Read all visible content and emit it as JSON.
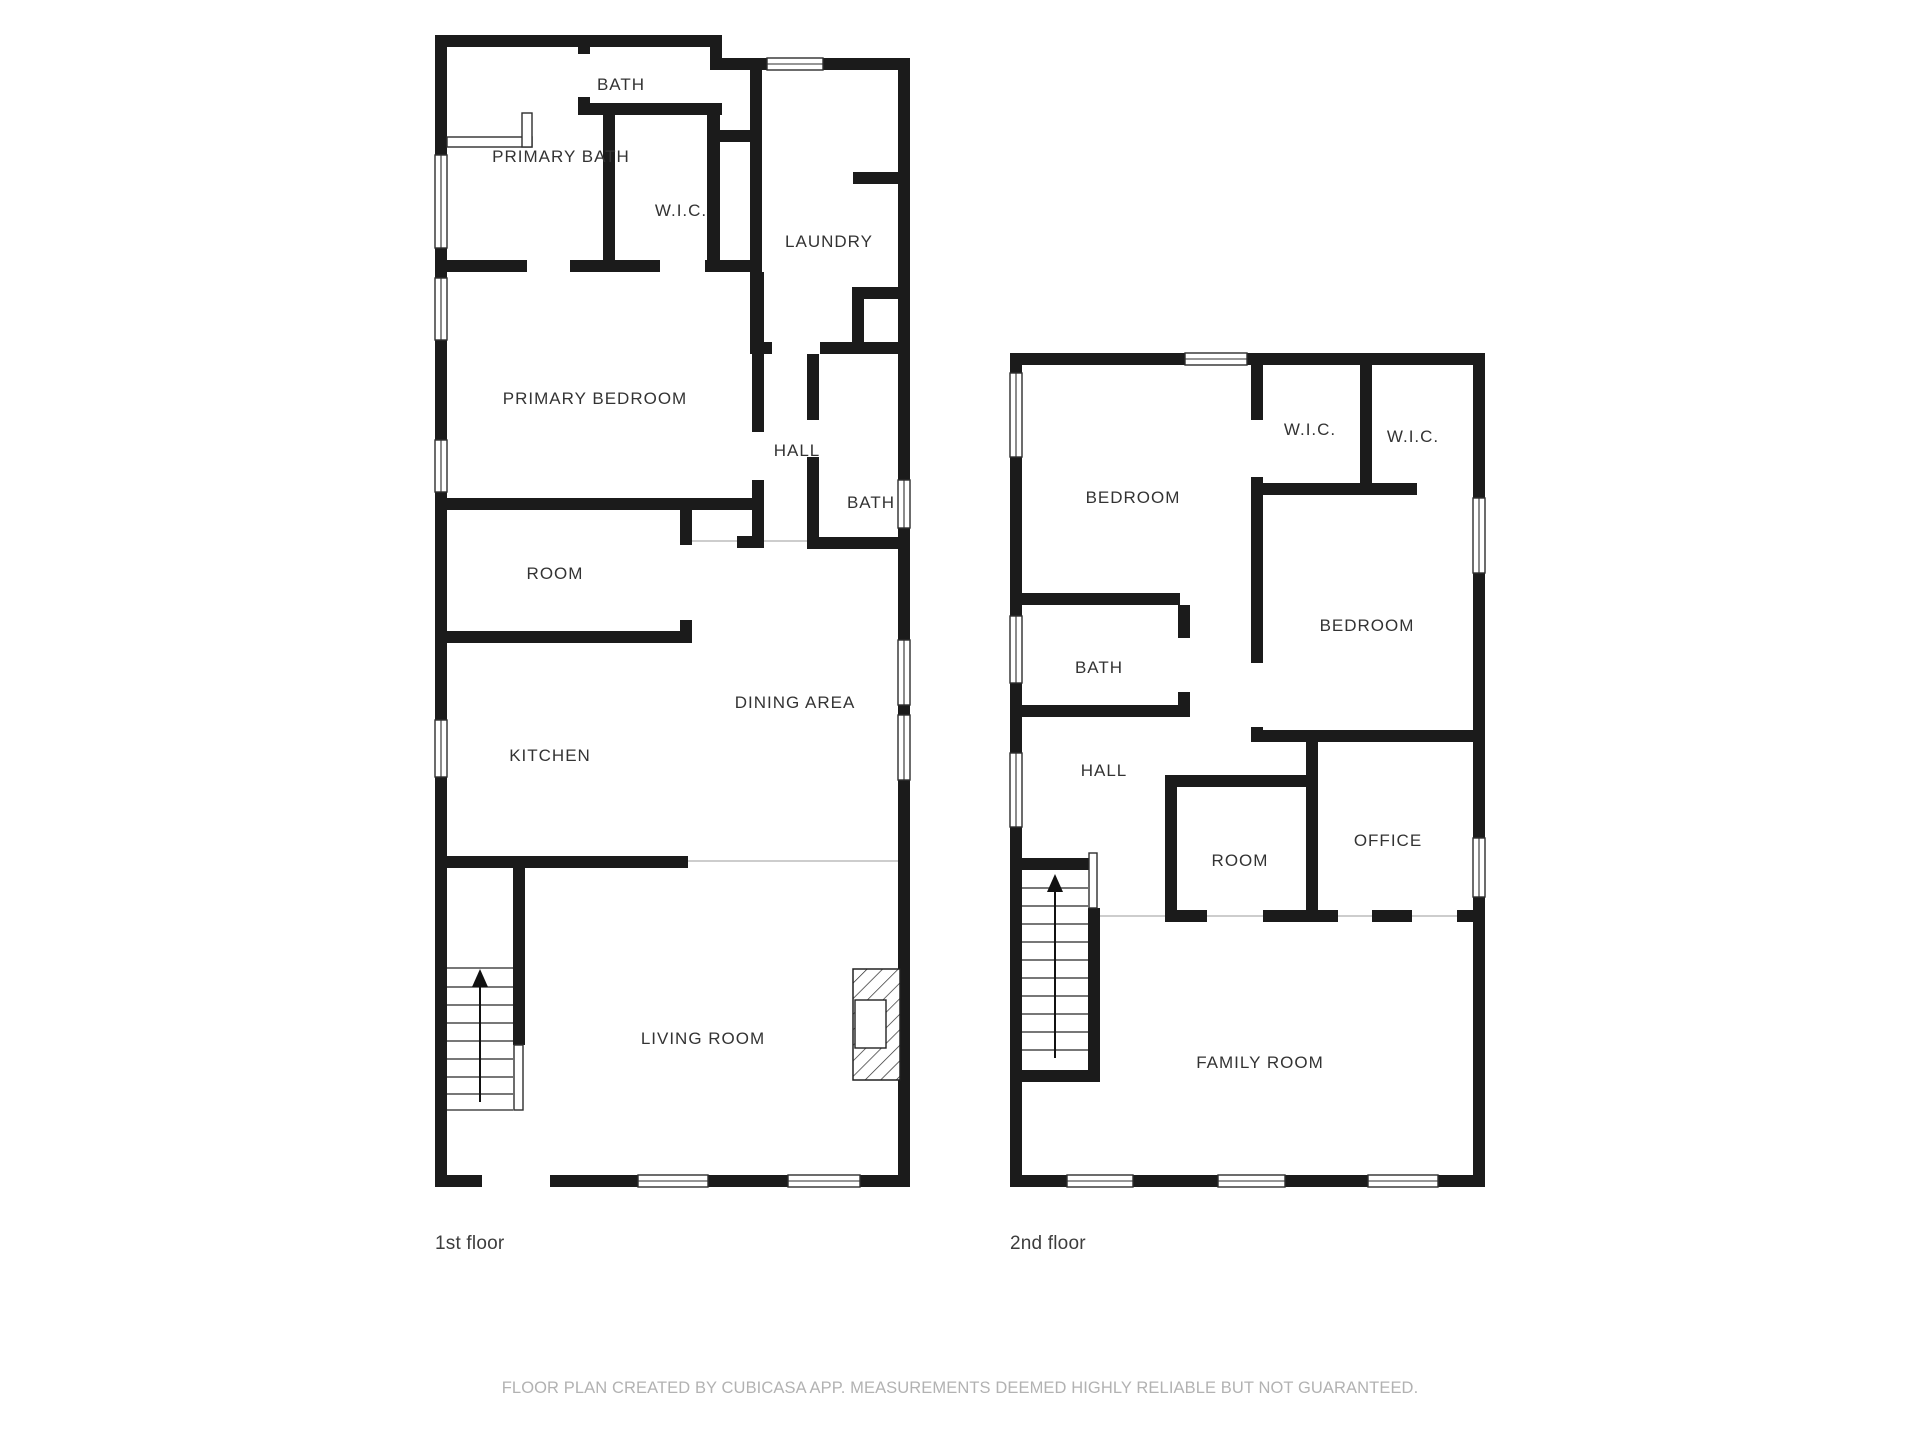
{
  "title": "Floor plan",
  "floors": [
    {
      "label": "1st floor",
      "rooms": [
        {
          "label": "BATH"
        },
        {
          "label": "PRIMARY BATH"
        },
        {
          "label": "W.I.C."
        },
        {
          "label": "LAUNDRY"
        },
        {
          "label": "PRIMARY BEDROOM"
        },
        {
          "label": "HALL"
        },
        {
          "label": "BATH"
        },
        {
          "label": "ROOM"
        },
        {
          "label": "DINING AREA"
        },
        {
          "label": "KITCHEN"
        },
        {
          "label": "LIVING ROOM"
        }
      ]
    },
    {
      "label": "2nd floor",
      "rooms": [
        {
          "label": "BEDROOM"
        },
        {
          "label": "W.I.C."
        },
        {
          "label": "W.I.C."
        },
        {
          "label": "BEDROOM"
        },
        {
          "label": "BATH"
        },
        {
          "label": "HALL"
        },
        {
          "label": "ROOM"
        },
        {
          "label": "OFFICE"
        },
        {
          "label": "FAMILY ROOM"
        }
      ]
    }
  ],
  "footer": {
    "disclaimer": "FLOOR PLAN CREATED BY CUBICASA APP. MEASUREMENTS DEEMED HIGHLY RELIABLE BUT NOT GUARANTEED."
  },
  "colors": {
    "wall": "#1b1b1b",
    "room_label": "#333333",
    "footer_text": "#b2b2b2",
    "open_boundary": "#cdcdcd"
  }
}
